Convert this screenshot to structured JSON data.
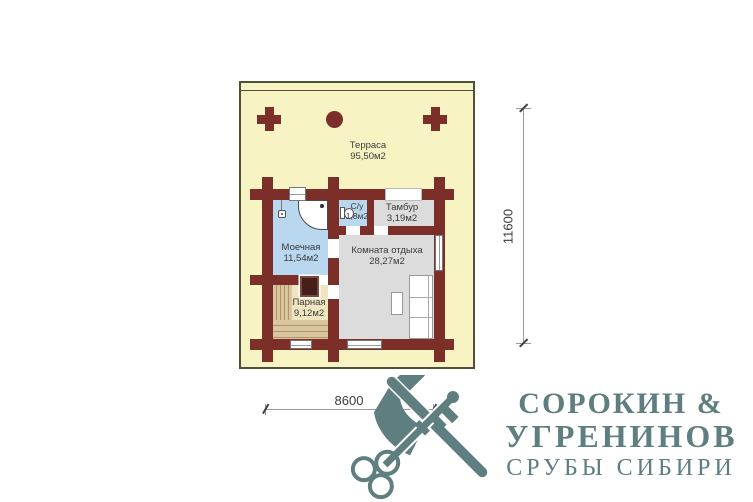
{
  "plan": {
    "rooms": [
      {
        "name": "Терраса",
        "area": "95,50м2"
      },
      {
        "name": "Моечная",
        "area": "11,54м2"
      },
      {
        "name": "С/у",
        "area": "1,8м2"
      },
      {
        "name": "Тамбур",
        "area": "3,19м2"
      },
      {
        "name": "Комната отдыха",
        "area": "28,27м2"
      },
      {
        "name": "Парная",
        "area": "9,12м2"
      }
    ],
    "dimensions": {
      "width": "8600",
      "height": "11600"
    }
  },
  "logo": {
    "line1": "СОРОКИН &",
    "line2": "УГРЕНИНОВ",
    "line3": "СРУБЫ СИБИРИ"
  },
  "colors": {
    "wall": "#7B2F28",
    "terrace": "#F8F3C2",
    "wet_floor": "#B9D7EF",
    "dry_floor": "#DCDCDC",
    "bench": "#D9C69E",
    "brand": "#5E7E80"
  }
}
